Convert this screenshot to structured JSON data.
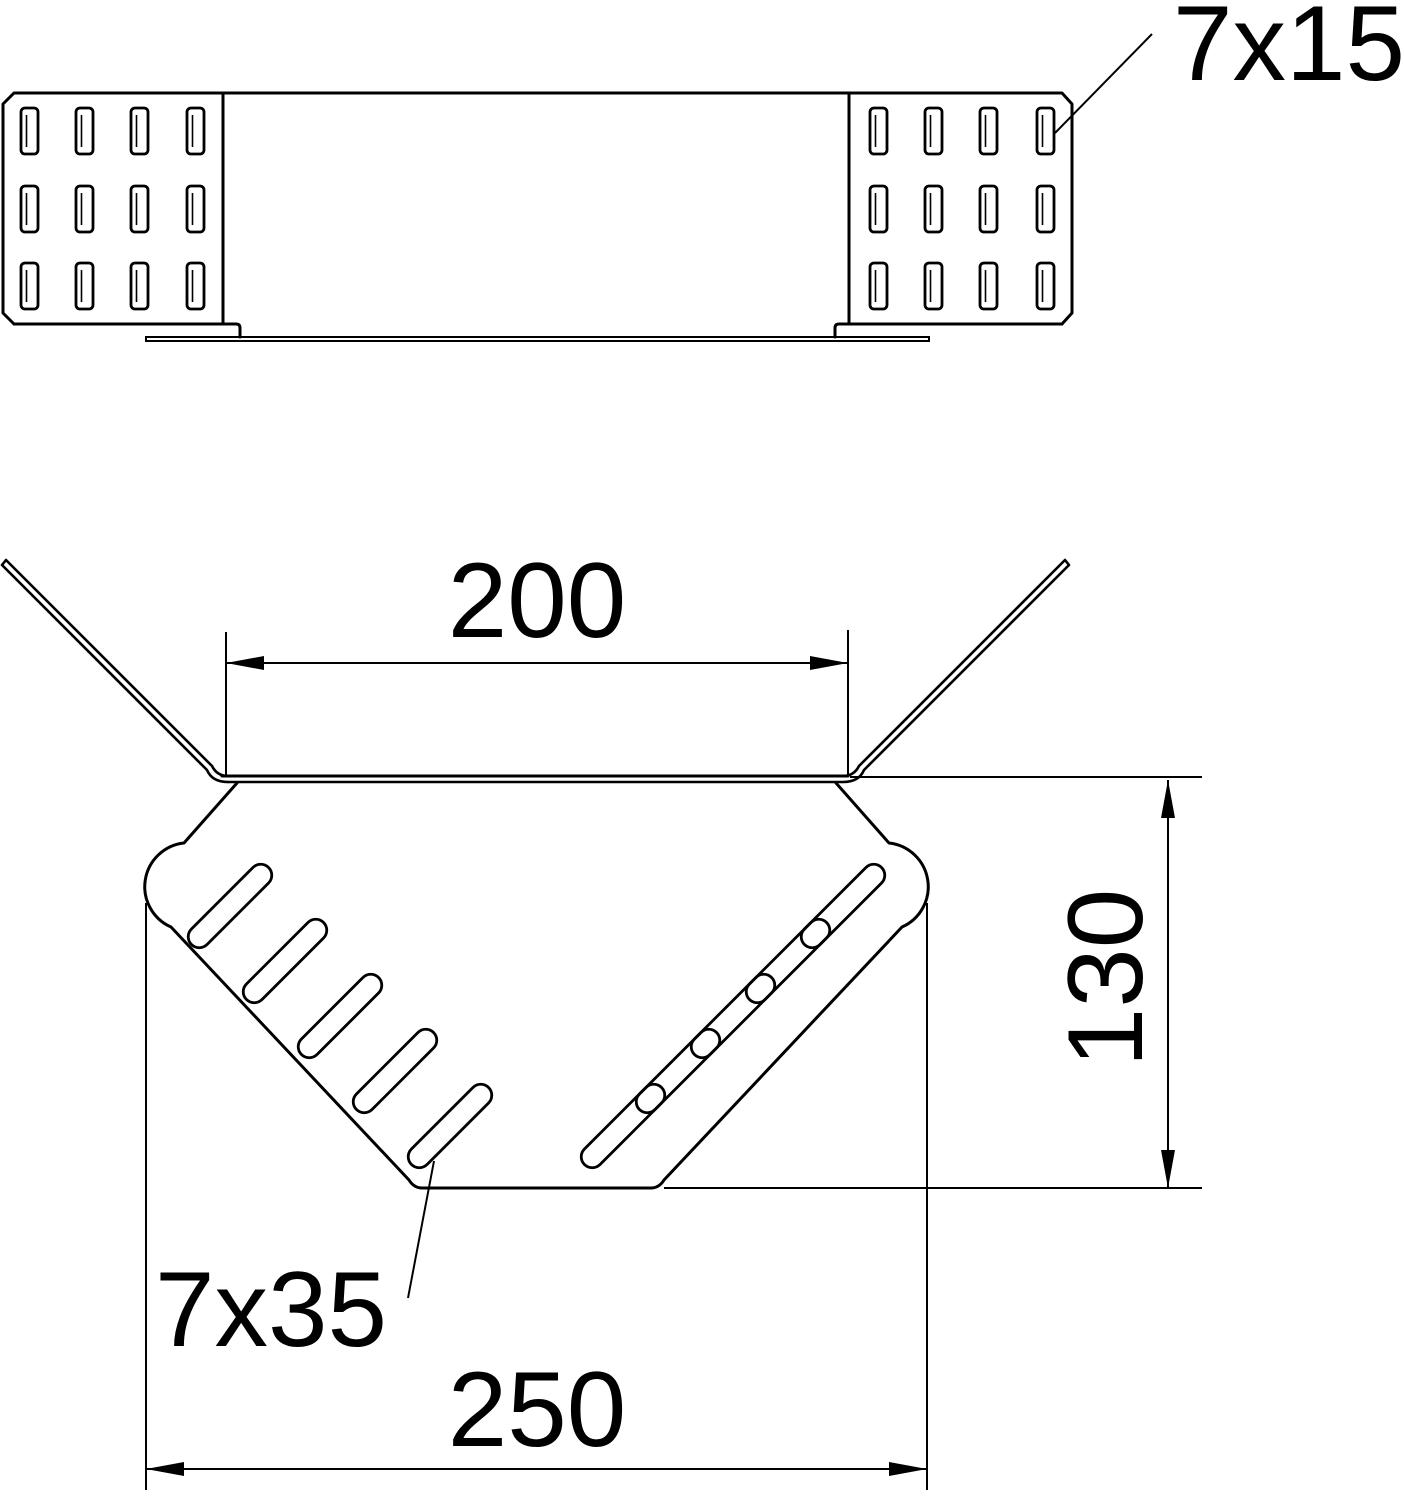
{
  "drawing": {
    "front_view": {
      "perforation_label": "7x15",
      "plates": 2,
      "slot_cols": 4,
      "slot_rows": 3
    },
    "plan_view": {
      "top_width": "200",
      "height": "130",
      "bottom_width": "250",
      "slot_label": "7x35",
      "slots_per_side": 5
    },
    "colors": {
      "line": "#000000",
      "background": "#ffffff"
    }
  }
}
